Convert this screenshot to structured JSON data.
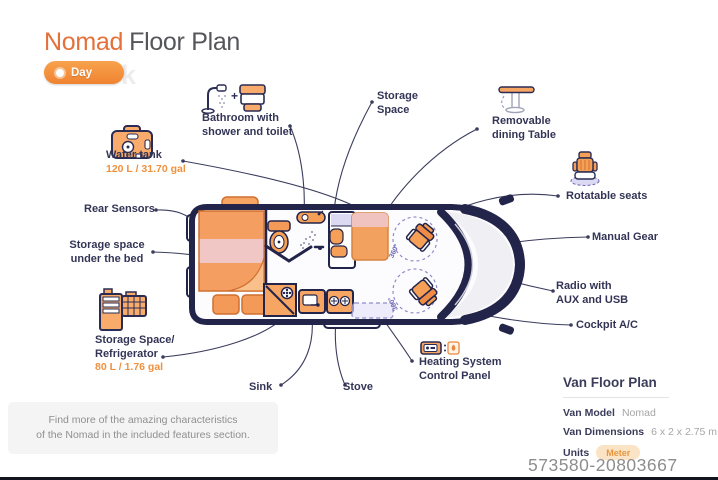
{
  "title": {
    "brand": "Nomad",
    "rest": "Floor Plan"
  },
  "mode_toggle": {
    "label": "Day",
    "icon": "sun-icon"
  },
  "background_watermark": "Truck",
  "colors": {
    "accent_orange": "#EE7C3E",
    "dark_navy": "#23244A",
    "purple": "#6C66B5",
    "pink": "#F1C7C6",
    "badge_bg": "#FBE4C5"
  },
  "van": {
    "rotation_badge": "360°"
  },
  "features": {
    "water_tank": {
      "name": "Water tank",
      "capacity": "120 L / 31.70 gal",
      "icon": "water-tank-icon"
    },
    "rear_sensors": {
      "name": "Rear Sensors"
    },
    "storage_under_bed": {
      "line1": "Storage space",
      "line2": "under the bed"
    },
    "fridge": {
      "line1": "Storage Space/",
      "line2": "Refrigerator",
      "capacity": "80 L / 1.76 gal",
      "icon": "refrigerator-icon"
    },
    "bathroom": {
      "line1": "Bathroom with",
      "line2": "shower and toilet",
      "plus": "+",
      "icons": "shower-icon toilet-icon"
    },
    "storage_space": {
      "line1": "Storage",
      "line2": "Space"
    },
    "dining_table": {
      "line1": "Removable",
      "line2": "dining Table",
      "icon": "dining-table-icon"
    },
    "rotatable_seats": {
      "name": "Rotatable seats",
      "icon": "seat-icon"
    },
    "manual_gear": {
      "name": "Manual Gear"
    },
    "radio": {
      "line1": "Radio with",
      "line2": "AUX and USB"
    },
    "cockpit_ac": {
      "name": "Cockpit A/C"
    },
    "heating": {
      "line1": "Heating System",
      "line2": "Control Panel",
      "icon": "heating-panel-icon"
    },
    "sink": {
      "name": "Sink"
    },
    "stove": {
      "name": "Stove"
    }
  },
  "info_box": {
    "line1": "Find more of the amazing characteristics",
    "line2": "of the Nomad in the included features section."
  },
  "panel": {
    "title": "Van Floor Plan",
    "rows": [
      {
        "label": "Van Model",
        "value": "Nomad"
      },
      {
        "label": "Van Dimensions",
        "value": "6 x 2 x 2.75 m"
      },
      {
        "label": "Units",
        "value": "Meter"
      }
    ]
  },
  "serial": "573580-20803667"
}
